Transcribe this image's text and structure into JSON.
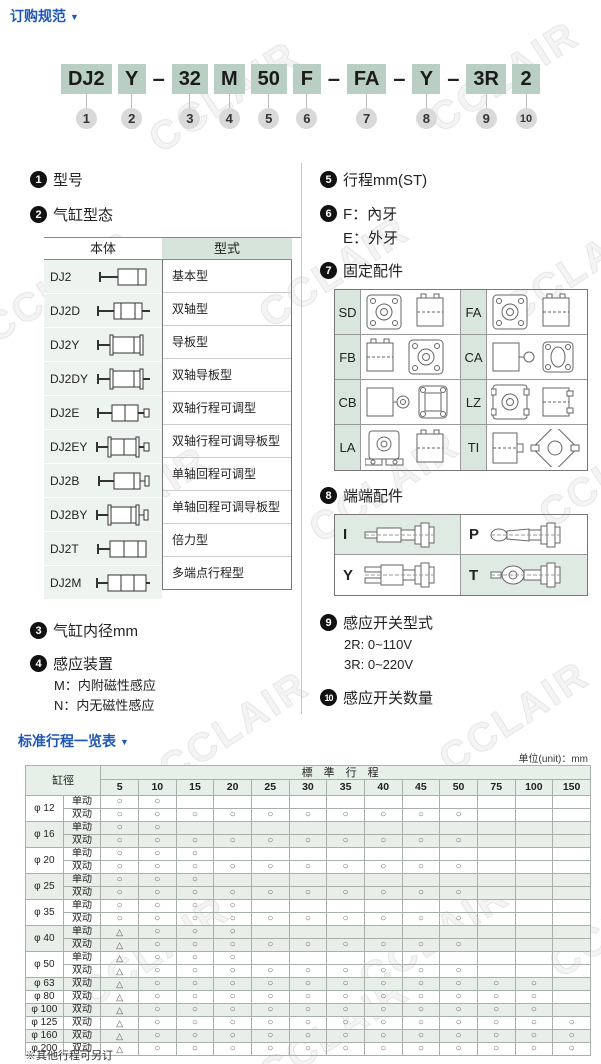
{
  "header": {
    "title": "订购规范",
    "arrow": "▼"
  },
  "model_code": {
    "segments": [
      {
        "t": "DJ2",
        "box": true,
        "n": "1"
      },
      {
        "t": "Y",
        "box": true,
        "n": "2"
      },
      {
        "t": "–",
        "box": false
      },
      {
        "t": "32",
        "box": true,
        "n": "3"
      },
      {
        "t": "M",
        "box": true,
        "n": "4"
      },
      {
        "t": "50",
        "box": true,
        "n": "5"
      },
      {
        "t": "F",
        "box": true,
        "n": "6"
      },
      {
        "t": "–",
        "box": false
      },
      {
        "t": "FA",
        "box": true,
        "n": "7"
      },
      {
        "t": "–",
        "box": false
      },
      {
        "t": "Y",
        "box": true,
        "n": "8"
      },
      {
        "t": "–",
        "box": false
      },
      {
        "t": "3R",
        "box": true,
        "n": "9"
      },
      {
        "t": "2",
        "box": true,
        "n": "10"
      }
    ]
  },
  "sections": {
    "s1": {
      "num": "1",
      "title": "型号"
    },
    "s2": {
      "num": "2",
      "title": "气缸型态"
    },
    "s3": {
      "num": "3",
      "title": "气缸内径mm"
    },
    "s4": {
      "num": "4",
      "title": "感应装置",
      "lines": [
        "M：内附磁性感应",
        "N：内无磁性感应"
      ]
    },
    "s5": {
      "num": "5",
      "title": "行程mm(ST)"
    },
    "s6": {
      "num": "6",
      "line1": "F：內牙",
      "line2": "E：外牙"
    },
    "s7": {
      "num": "7",
      "title": "固定配件"
    },
    "s8": {
      "num": "8",
      "title": "端端配件"
    },
    "s9": {
      "num": "9",
      "title": "感应开关型式",
      "lines": [
        "2R: 0~110V",
        "3R: 0~220V"
      ]
    },
    "s10": {
      "num": "10",
      "title": "感应开关数量"
    }
  },
  "type_table": {
    "headers": [
      "本体",
      "型式"
    ],
    "rows": [
      {
        "model": "DJ2",
        "type": "基本型"
      },
      {
        "model": "DJ2D",
        "type": "双轴型"
      },
      {
        "model": "DJ2Y",
        "type": "导板型"
      },
      {
        "model": "DJ2DY",
        "type": "双轴导板型"
      },
      {
        "model": "DJ2E",
        "type": "双轴行程可调型"
      },
      {
        "model": "DJ2EY",
        "type": "双轴行程可调导板型"
      },
      {
        "model": "DJ2B",
        "type": "单轴回程可调型"
      },
      {
        "model": "DJ2BY",
        "type": "单轴回程可调导板型"
      },
      {
        "model": "DJ2T",
        "type": "倍力型"
      },
      {
        "model": "DJ2M",
        "type": "多端点行程型"
      }
    ]
  },
  "mount_table": {
    "cells": [
      {
        "label": "SD"
      },
      {
        "label": "FA"
      },
      {
        "label": "FB"
      },
      {
        "label": "CA"
      },
      {
        "label": "CB"
      },
      {
        "label": "LZ"
      },
      {
        "label": "LA"
      },
      {
        "label": "TI"
      }
    ]
  },
  "end_table": {
    "cells": [
      {
        "label": "I"
      },
      {
        "label": "P"
      },
      {
        "label": "Y"
      },
      {
        "label": "T"
      }
    ]
  },
  "stroke_table": {
    "title": "标准行程一览表",
    "arrow": "▼",
    "unit": "单位(unit)：mm",
    "corner_header": "缸徑",
    "span_header": "標準行程",
    "columns": [
      "5",
      "10",
      "15",
      "20",
      "25",
      "30",
      "35",
      "40",
      "45",
      "50",
      "75",
      "100",
      "150"
    ],
    "rows": [
      {
        "bore": "φ 12",
        "action": "单动",
        "shade": false,
        "marks": [
          "○",
          "○",
          "",
          "",
          "",
          "",
          "",
          "",
          "",
          "",
          "",
          "",
          ""
        ]
      },
      {
        "bore": "φ 12",
        "action": "双动",
        "shade": false,
        "marks": [
          "○",
          "○",
          "○",
          "○",
          "○",
          "○",
          "○",
          "○",
          "○",
          "○",
          "",
          "",
          ""
        ]
      },
      {
        "bore": "φ 16",
        "action": "单动",
        "shade": true,
        "marks": [
          "○",
          "○",
          "",
          "",
          "",
          "",
          "",
          "",
          "",
          "",
          "",
          "",
          ""
        ]
      },
      {
        "bore": "φ 16",
        "action": "双动",
        "shade": true,
        "marks": [
          "○",
          "○",
          "○",
          "○",
          "○",
          "○",
          "○",
          "○",
          "○",
          "○",
          "",
          "",
          ""
        ]
      },
      {
        "bore": "φ 20",
        "action": "单动",
        "shade": false,
        "marks": [
          "○",
          "○",
          "○",
          "",
          "",
          "",
          "",
          "",
          "",
          "",
          "",
          "",
          ""
        ]
      },
      {
        "bore": "φ 20",
        "action": "双动",
        "shade": false,
        "marks": [
          "○",
          "○",
          "○",
          "○",
          "○",
          "○",
          "○",
          "○",
          "○",
          "○",
          "",
          "",
          ""
        ]
      },
      {
        "bore": "φ 25",
        "action": "单动",
        "shade": true,
        "marks": [
          "○",
          "○",
          "○",
          "",
          "",
          "",
          "",
          "",
          "",
          "",
          "",
          "",
          ""
        ]
      },
      {
        "bore": "φ 25",
        "action": "双动",
        "shade": true,
        "marks": [
          "○",
          "○",
          "○",
          "○",
          "○",
          "○",
          "○",
          "○",
          "○",
          "○",
          "",
          "",
          ""
        ]
      },
      {
        "bore": "φ 35",
        "action": "单动",
        "shade": false,
        "marks": [
          "○",
          "○",
          "○",
          "○",
          "",
          "",
          "",
          "",
          "",
          "",
          "",
          "",
          ""
        ]
      },
      {
        "bore": "φ 35",
        "action": "双动",
        "shade": false,
        "marks": [
          "○",
          "○",
          "○",
          "○",
          "○",
          "○",
          "○",
          "○",
          "○",
          "○",
          "",
          "",
          ""
        ]
      },
      {
        "bore": "φ 40",
        "action": "单动",
        "shade": true,
        "marks": [
          "△",
          "○",
          "○",
          "○",
          "",
          "",
          "",
          "",
          "",
          "",
          "",
          "",
          ""
        ]
      },
      {
        "bore": "φ 40",
        "action": "双动",
        "shade": true,
        "marks": [
          "△",
          "○",
          "○",
          "○",
          "○",
          "○",
          "○",
          "○",
          "○",
          "○",
          "",
          "",
          ""
        ]
      },
      {
        "bore": "φ 50",
        "action": "单动",
        "shade": false,
        "marks": [
          "△",
          "○",
          "○",
          "○",
          "",
          "",
          "",
          "",
          "",
          "",
          "",
          "",
          ""
        ]
      },
      {
        "bore": "φ 50",
        "action": "双动",
        "shade": false,
        "marks": [
          "△",
          "○",
          "○",
          "○",
          "○",
          "○",
          "○",
          "○",
          "○",
          "○",
          "",
          "",
          ""
        ]
      },
      {
        "bore": "φ 63",
        "action": "双动",
        "shade": true,
        "marks": [
          "△",
          "○",
          "○",
          "○",
          "○",
          "○",
          "○",
          "○",
          "○",
          "○",
          "○",
          "○",
          ""
        ]
      },
      {
        "bore": "φ 80",
        "action": "双动",
        "shade": false,
        "marks": [
          "△",
          "○",
          "○",
          "○",
          "○",
          "○",
          "○",
          "○",
          "○",
          "○",
          "○",
          "○",
          ""
        ]
      },
      {
        "bore": "φ 100",
        "action": "双动",
        "shade": true,
        "marks": [
          "△",
          "○",
          "○",
          "○",
          "○",
          "○",
          "○",
          "○",
          "○",
          "○",
          "○",
          "○",
          ""
        ]
      },
      {
        "bore": "φ 125",
        "action": "双动",
        "shade": false,
        "marks": [
          "△",
          "○",
          "○",
          "○",
          "○",
          "○",
          "○",
          "○",
          "○",
          "○",
          "○",
          "○",
          "○"
        ]
      },
      {
        "bore": "φ 160",
        "action": "双动",
        "shade": true,
        "marks": [
          "△",
          "○",
          "○",
          "○",
          "○",
          "○",
          "○",
          "○",
          "○",
          "○",
          "○",
          "○",
          "○"
        ]
      },
      {
        "bore": "φ 200",
        "action": "双动",
        "shade": false,
        "marks": [
          "△",
          "○",
          "○",
          "○",
          "○",
          "○",
          "○",
          "○",
          "○",
          "○",
          "○",
          "○",
          "○"
        ]
      }
    ],
    "footnote": "※其他行程可另订"
  },
  "colors": {
    "accent_blue": "#1f57b5",
    "box_green": "#b9cfc4",
    "cell_green": "#d6e4db",
    "light_green": "#edf3ef",
    "row_shade": "#e8efe9"
  },
  "watermark_text": "CCLAIR"
}
